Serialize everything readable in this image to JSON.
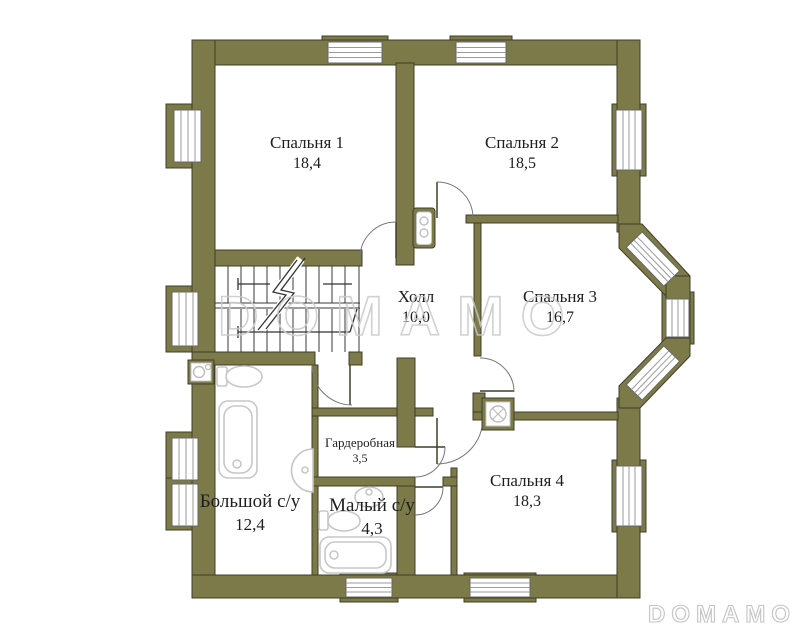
{
  "watermark": {
    "center": "DOMAMO",
    "corner": "DOMAMO"
  },
  "rooms": [
    {
      "key": "bedroom-1",
      "name": "Спальня 1",
      "area": "18,4"
    },
    {
      "key": "bedroom-2",
      "name": "Спальня 2",
      "area": "18,5"
    },
    {
      "key": "bedroom-3",
      "name": "Спальня 3",
      "area": "16,7"
    },
    {
      "key": "hall",
      "name": "Холл",
      "area": "10,0"
    },
    {
      "key": "wardrobe",
      "name": "Гардеробная",
      "area": "3,5"
    },
    {
      "key": "bathroom-large",
      "name": "Большой с/у",
      "area": "12,4"
    },
    {
      "key": "bathroom-small",
      "name": "Малый с/у",
      "area": "4,3"
    },
    {
      "key": "bedroom-4",
      "name": "Спальня 4",
      "area": "18,3"
    }
  ],
  "colors": {
    "wall": "#7b7a48",
    "wall_outline": "#3f3f28",
    "fixture_outline": "#c7c7c7",
    "watermark_outline": "#c9c9c9",
    "label_text": "#1e1e1e",
    "background": "#ffffff"
  },
  "icons": [
    "staircase",
    "bathtub-icon",
    "toilet-icon",
    "sink-icon",
    "vent-fan-icon",
    "window",
    "door-swing"
  ]
}
